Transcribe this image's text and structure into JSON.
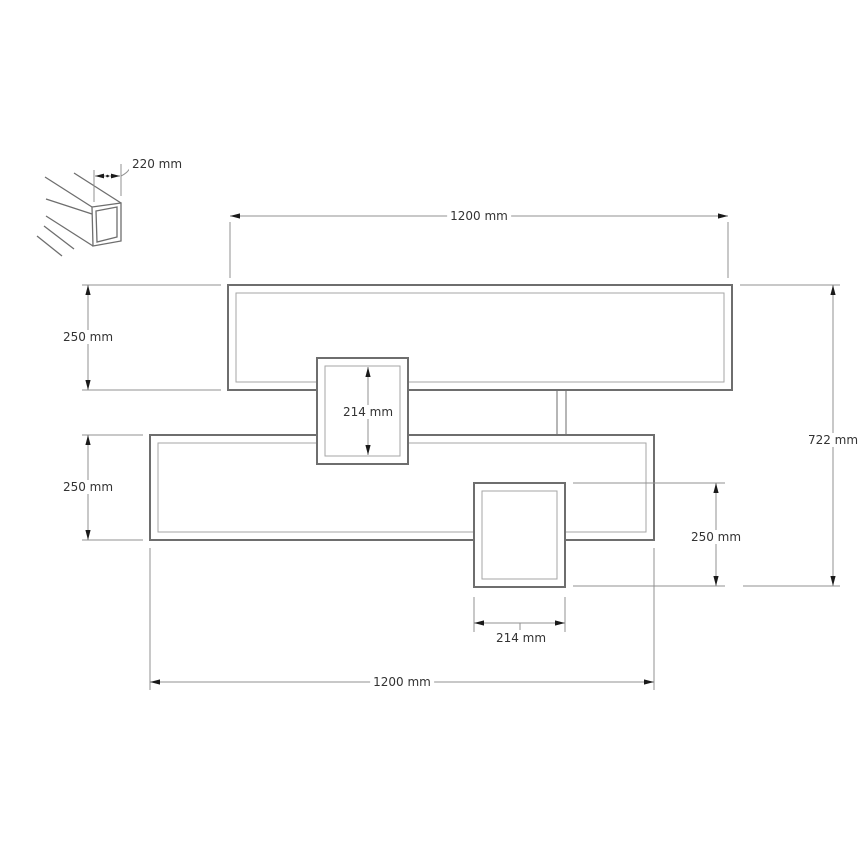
{
  "diagram": {
    "description": "Technical dimension drawing of a two-tier wall shelf with two connecting box modules and an isometric detail of the hollow rectangular profile",
    "profile_inset": {
      "dimension": "220 mm"
    },
    "labels": {
      "top_width": "1200 mm",
      "upper_shelf_height": "250 mm",
      "lower_shelf_height": "250 mm",
      "overall_height": "722 mm",
      "upper_box_height": "214 mm",
      "lower_box_height": "250 mm",
      "lower_box_width": "214 mm",
      "bottom_width": "1200 mm"
    },
    "colors": {
      "background": "#ffffff",
      "outline": "#6e6e6e",
      "inner_line": "#a6a6a6",
      "dimension_line": "#909090",
      "arrow": "#1a1a1a",
      "text": "#333333"
    }
  }
}
